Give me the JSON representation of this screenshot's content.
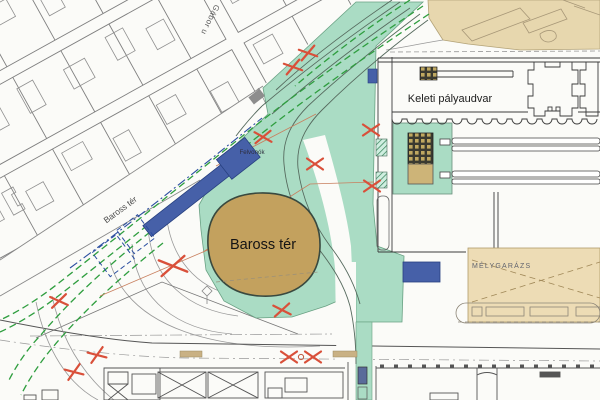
{
  "map": {
    "labels": {
      "station": "Keleti pályaudvar",
      "square": "Baross tér",
      "street_diagonal": "Baross tér",
      "street_top": "Gábor u",
      "elevators": "Felvonók",
      "garage": "MÉLYGARÁZS"
    },
    "colors": {
      "park_green": "#aadcc4",
      "square_tan": "#c3a15e",
      "platform_tan": "#e7d7ae",
      "garage_tan": "#eddcb5",
      "structure_blue": "#4660a8",
      "tram_green": "#2f9e3f",
      "demolition_red": "#d9503a"
    }
  }
}
